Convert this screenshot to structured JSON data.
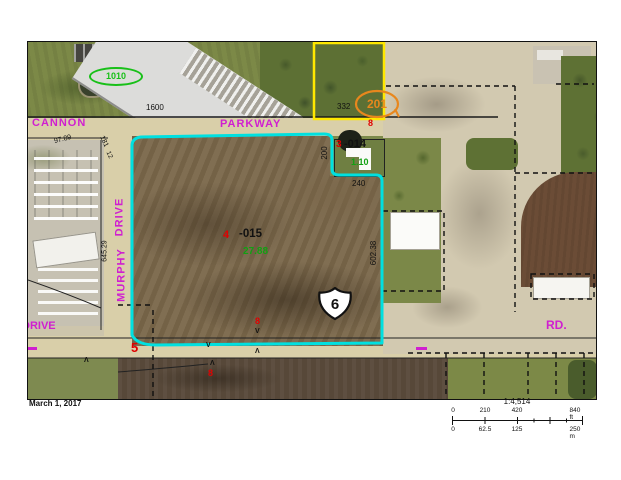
{
  "map": {
    "streets": {
      "cannon": "CANNON",
      "parkway": "PARKWAY",
      "drive": "DRIVE",
      "murphy": "MURPHY",
      "rd": "RD.",
      "drive_west": "DRIVE"
    },
    "address_ovals": {
      "green_1010": "1010",
      "orange_201": "201"
    },
    "route_shield": {
      "number": "6"
    },
    "parcel_labels": {
      "lot332": "332",
      "red8_north": "8",
      "red8_field": "8",
      "red8_south": "8",
      "red3": "3",
      "num014": "-014",
      "acres014": "1.10",
      "red4": "4",
      "num015": "-015",
      "acres015": "27.88",
      "red5": "5"
    },
    "dimensions": {
      "d1600": "1600",
      "d9789": "97.89",
      "d181": "181",
      "d12": "12",
      "d64529": "645.29",
      "d240": "240",
      "d200": "200",
      "d60238": "602.38"
    },
    "survey_marks": [
      "V",
      "V",
      "Λ",
      "Λ",
      "Λ"
    ]
  },
  "footer": {
    "date": "March 1, 2017",
    "scale_ratio": "1:4,514",
    "scale_ft": [
      "0",
      "210",
      "420",
      "840 ft"
    ],
    "scale_m": [
      "0",
      "62.5",
      "125",
      "250 m"
    ]
  },
  "colors": {
    "parcel_highlight_cyan": "#00e0e0",
    "parcel_yellow": "#ffe800",
    "oval_orange": "#e8871d",
    "street_magenta": "#d01fd0",
    "label_red": "#e00000",
    "label_green": "#12a012"
  }
}
